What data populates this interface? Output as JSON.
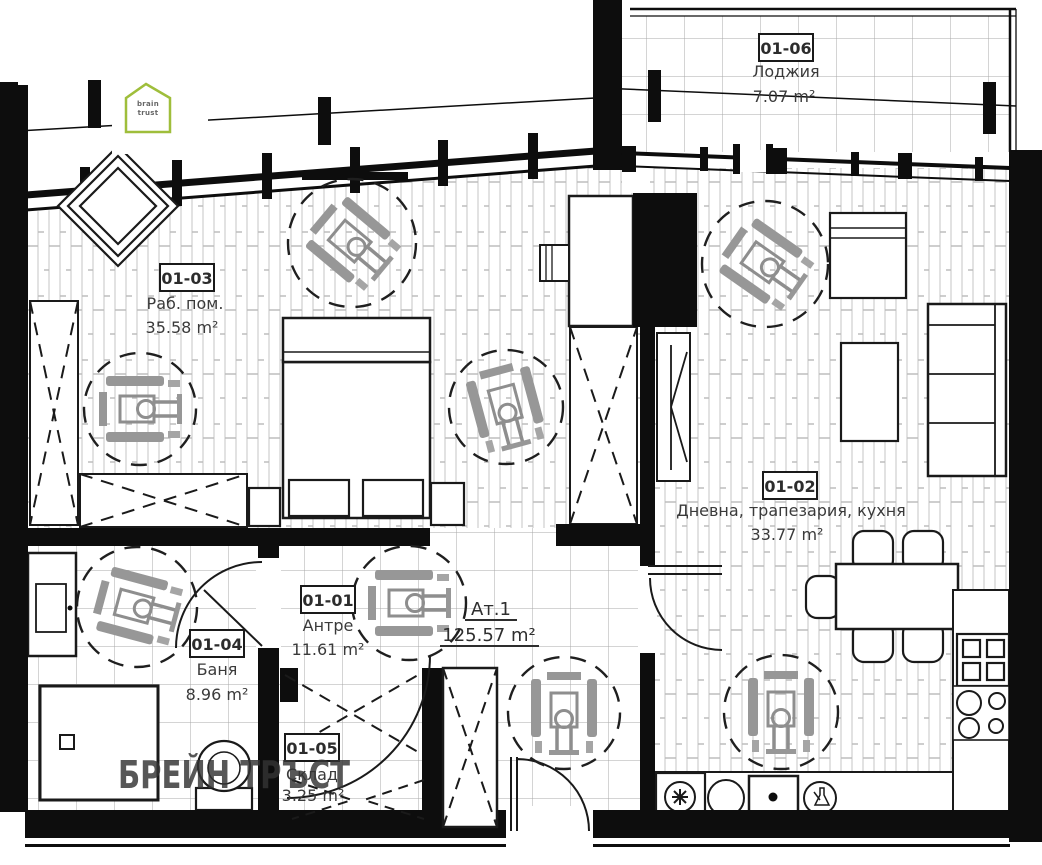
{
  "plan": {
    "title": "Apartment floor plan",
    "watermark": "БРЕЙН ТРЪСТ",
    "logo": {
      "line1": "brain",
      "line2": "trust"
    },
    "apartment": {
      "name": "Ат.1",
      "area": "125.57 m²"
    },
    "rooms": [
      {
        "id": "01-06",
        "name": "Лоджия",
        "area": "7.07 m²"
      },
      {
        "id": "01-03",
        "name": "Раб. пом.",
        "area": "35.58 m²"
      },
      {
        "id": "01-02",
        "name": "Дневна, трапезария, кухня",
        "area": "33.77 m²"
      },
      {
        "id": "01-01",
        "name": "Антре",
        "area": "11.61 m²"
      },
      {
        "id": "01-04",
        "name": "Баня",
        "area": "8.96 m²"
      },
      {
        "id": "01-05",
        "name": "Склад",
        "area": "3.25 m²"
      }
    ],
    "colors": {
      "wall": "#0d0d0d",
      "watermark": "#b0524e",
      "logo_green": "#9fbe3b"
    }
  }
}
